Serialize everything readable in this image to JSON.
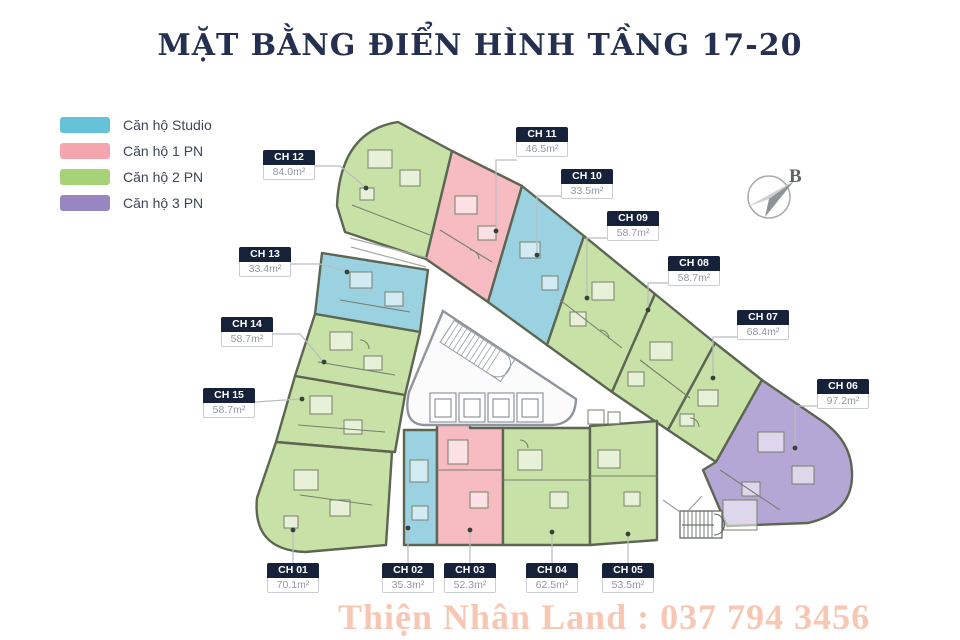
{
  "title": "MẶT BẰNG ĐIỂN HÌNH TẦNG 17-20",
  "compass": {
    "label": "B"
  },
  "watermark": "Thiện Nhân Land : 037 794 3456",
  "legend": {
    "items": [
      {
        "label": "Căn hộ Studio",
        "color": "#66c2d8"
      },
      {
        "label": "Căn hộ 1 PN",
        "color": "#f4a5ad"
      },
      {
        "label": "Căn hộ 2 PN",
        "color": "#a8d277"
      },
      {
        "label": "Căn hộ 3 PN",
        "color": "#9886c3"
      }
    ]
  },
  "plan_colors": {
    "studio": "#9bd2e2",
    "pn1": "#f6bcc2",
    "pn2": "#c8e1a7",
    "pn3": "#b5a7d5",
    "wall": "#5c6652",
    "core_fill": "#fbfbfb",
    "core_wall": "#8f959d"
  },
  "units": {
    "ch01": {
      "id": "CH 01",
      "area": "70.1m²",
      "type": "2PN"
    },
    "ch02": {
      "id": "CH 02",
      "area": "35.3m²",
      "type": "Studio"
    },
    "ch03": {
      "id": "CH 03",
      "area": "52.3m²",
      "type": "1PN"
    },
    "ch04": {
      "id": "CH 04",
      "area": "62.5m²",
      "type": "2PN"
    },
    "ch05": {
      "id": "CH 05",
      "area": "53.5m²",
      "type": "2PN"
    },
    "ch06": {
      "id": "CH 06",
      "area": "97.2m²",
      "type": "3PN"
    },
    "ch07": {
      "id": "CH 07",
      "area": "68.4m²",
      "type": "2PN"
    },
    "ch08": {
      "id": "CH 08",
      "area": "58.7m²",
      "type": "2PN"
    },
    "ch09": {
      "id": "CH 09",
      "area": "58.7m²",
      "type": "2PN"
    },
    "ch10": {
      "id": "CH 10",
      "area": "33.5m²",
      "type": "Studio"
    },
    "ch11": {
      "id": "CH 11",
      "area": "46.5m²",
      "type": "1PN"
    },
    "ch12": {
      "id": "CH 12",
      "area": "84.0m²",
      "type": "2PN"
    },
    "ch13": {
      "id": "CH 13",
      "area": "33.4m²",
      "type": "Studio"
    },
    "ch14": {
      "id": "CH 14",
      "area": "58.7m²",
      "type": "2PN"
    },
    "ch15": {
      "id": "CH 15",
      "area": "58.7m²",
      "type": "2PN"
    }
  }
}
